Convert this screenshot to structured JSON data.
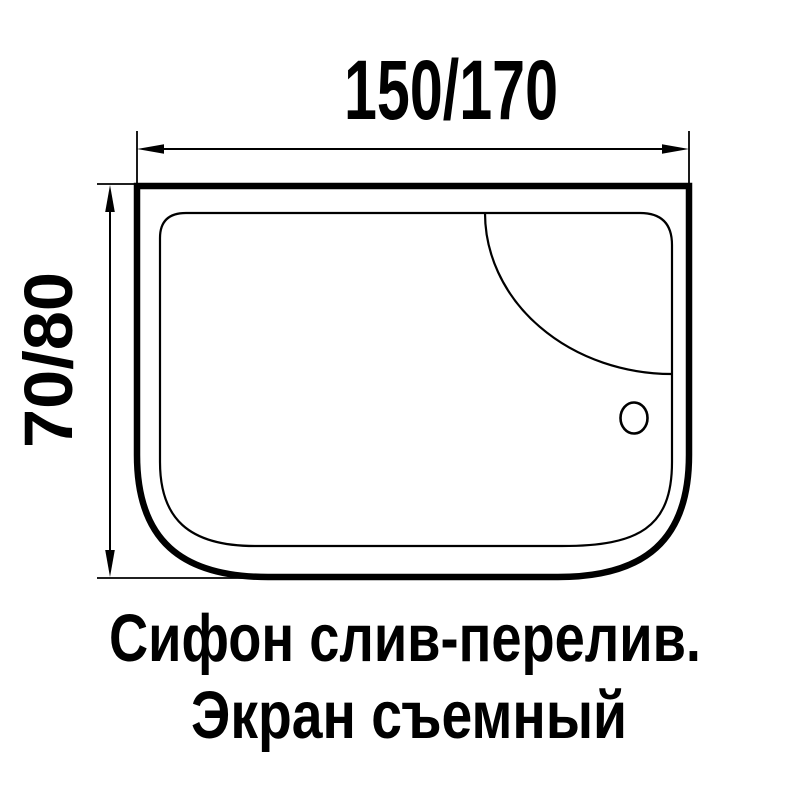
{
  "diagram": {
    "kind": "bathtub-top-view-dimension-drawing",
    "dimensions": {
      "width_label": "150/170",
      "height_label": "70/80"
    },
    "caption": {
      "line1": "Сифон слив-перелив.",
      "line2": "Экран съемный"
    },
    "colors": {
      "line": "#000000",
      "background": "#ffffff"
    }
  }
}
